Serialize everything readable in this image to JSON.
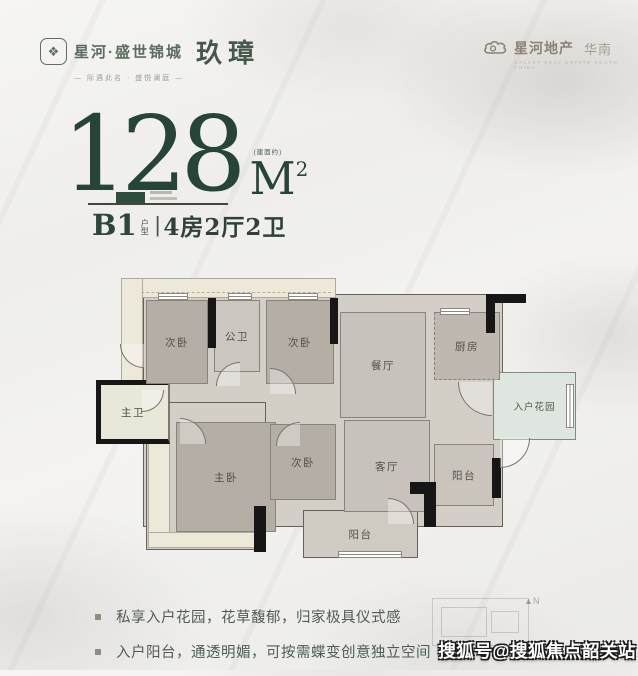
{
  "brand_left": {
    "title": "星河·盛世锦城",
    "suffix": "玖璋",
    "tagline": "— 际遇此名 · 盛悦澜庭 —"
  },
  "brand_right": {
    "title": "星河地产",
    "region": "华南",
    "subtext": "GALAXY REAL ESTATE SOUTH CHINA"
  },
  "headline": {
    "area_value": "128",
    "area_note": "(建面约)",
    "area_unit": "M",
    "area_sup": "2",
    "plan_code": "B1",
    "plan_caption_top": "户",
    "plan_caption_bottom": "型",
    "separator": "|",
    "plan_layout": "4房2厅2卫"
  },
  "floorplan": {
    "rooms": [
      {
        "id": "bedroom-a",
        "label": "次卧"
      },
      {
        "id": "bath-public",
        "label": "公卫"
      },
      {
        "id": "bedroom-b",
        "label": "次卧"
      },
      {
        "id": "dining",
        "label": "餐厅"
      },
      {
        "id": "kitchen",
        "label": "厨房"
      },
      {
        "id": "entry-garden",
        "label": "入户花园"
      },
      {
        "id": "master-bath",
        "label": "主卫"
      },
      {
        "id": "master-bedroom",
        "label": "主卧"
      },
      {
        "id": "bedroom-c",
        "label": "次卧"
      },
      {
        "id": "living",
        "label": "客厅"
      },
      {
        "id": "balcony-main",
        "label": "阳台"
      },
      {
        "id": "balcony-side",
        "label": "阳台"
      }
    ]
  },
  "features": {
    "items": [
      "私享入户花园，花草馥郁，归家极具仪式感",
      "入户阳台，通透明媚，可按需蝶变创意独立空间"
    ]
  },
  "watermark": {
    "text": "搜狐号@搜狐焦点韶关站"
  },
  "compass": {
    "label": "N"
  },
  "colors": {
    "accent_green": "#274537",
    "logo_green": "#5a6c5e",
    "logo_brown": "#8b8274",
    "room_taupe": "#b5aea5",
    "cream_band": "#ece9d8",
    "garden_mint": "#dfe6df"
  }
}
